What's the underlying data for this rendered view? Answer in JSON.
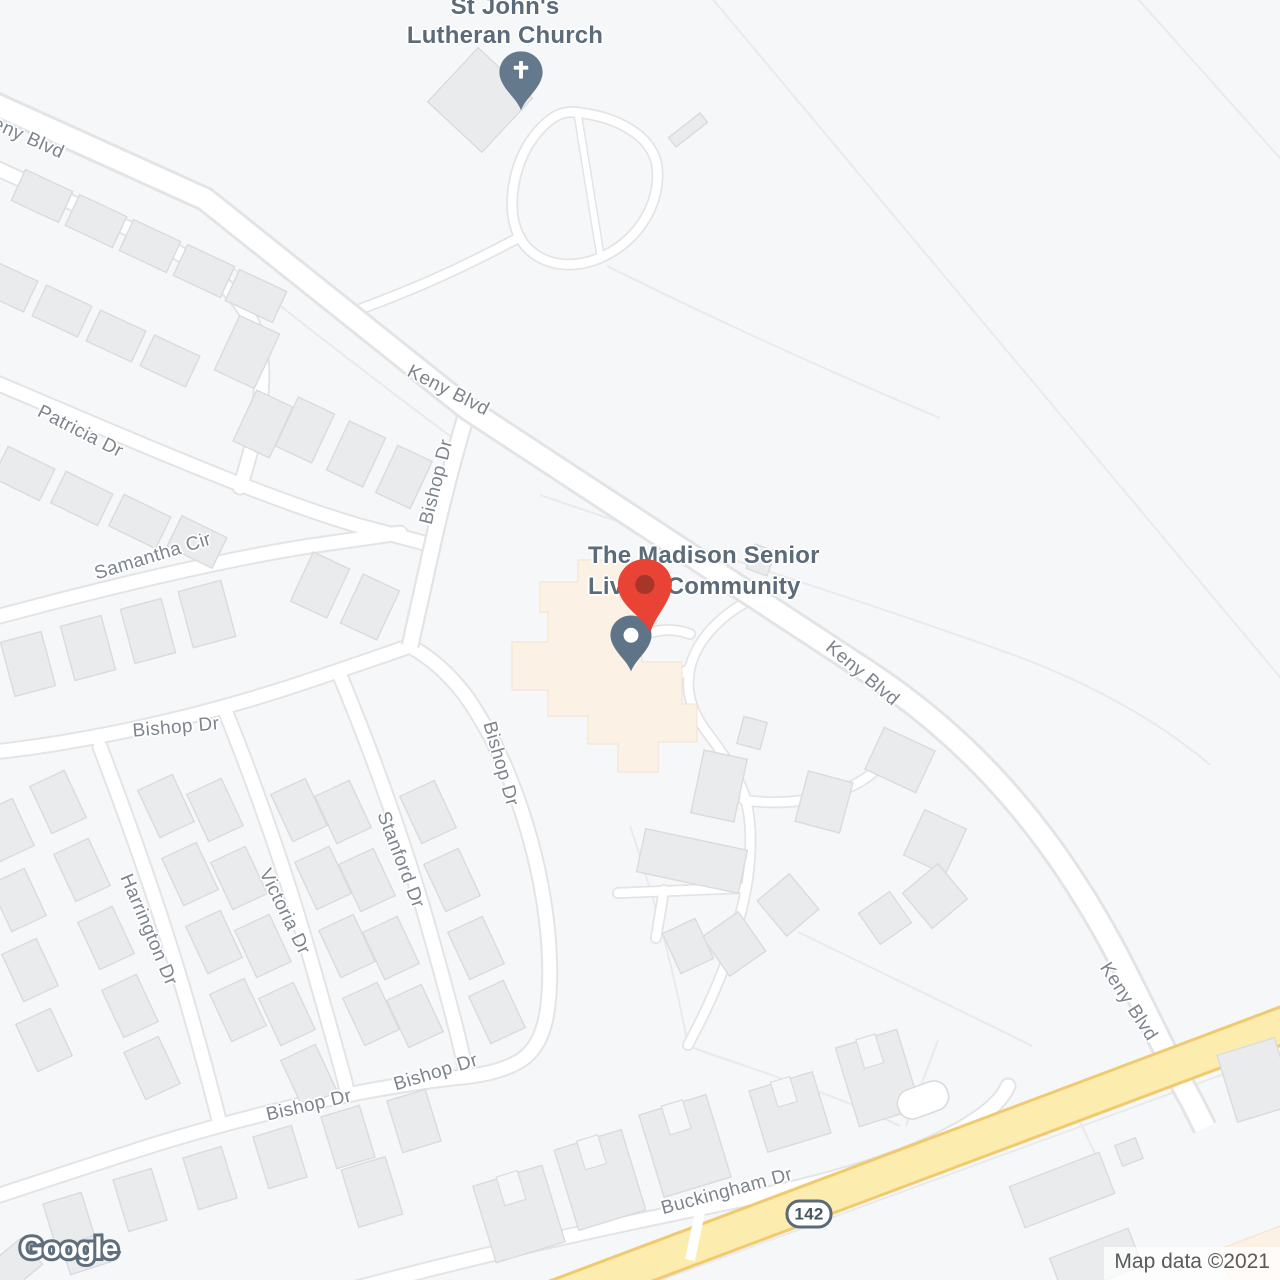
{
  "map": {
    "watermark": "Google",
    "attribution": "Map data ©2021"
  },
  "route_shield": {
    "number": "142"
  },
  "poi_labels": {
    "church": {
      "line1": "St John's",
      "line2": "Lutheran Church"
    },
    "madison": {
      "line1": "The Madison Senior",
      "line2": "Living Community"
    }
  },
  "markers": {
    "church_pin": "church-pin",
    "madison_place_pin": "red-place-pin",
    "madison_poi_pin": "slate-poi-pin"
  },
  "road_labels": [
    {
      "id": "keny-blvd-1",
      "text": "Keny Blvd",
      "x": 22,
      "y": 136,
      "rot": 24
    },
    {
      "id": "keny-blvd-2",
      "text": "Keny Blvd",
      "x": 448,
      "y": 391,
      "rot": 27
    },
    {
      "id": "keny-blvd-3",
      "text": "Keny Blvd",
      "x": 862,
      "y": 674,
      "rot": 40
    },
    {
      "id": "keny-blvd-4",
      "text": "Keny Blvd",
      "x": 1128,
      "y": 1002,
      "rot": 57
    },
    {
      "id": "bishop-dr-1",
      "text": "Bishop Dr",
      "x": 437,
      "y": 482,
      "rot": -76
    },
    {
      "id": "patricia-dr",
      "text": "Patricia Dr",
      "x": 80,
      "y": 432,
      "rot": 27
    },
    {
      "id": "samantha-cir",
      "text": "Samantha Cir",
      "x": 153,
      "y": 557,
      "rot": -17
    },
    {
      "id": "bishop-dr-2",
      "text": "Bishop Dr",
      "x": 176,
      "y": 728,
      "rot": -5
    },
    {
      "id": "bishop-dr-3",
      "text": "Bishop Dr",
      "x": 500,
      "y": 764,
      "rot": 74
    },
    {
      "id": "stanford-dr",
      "text": "Stanford Dr",
      "x": 400,
      "y": 860,
      "rot": 69
    },
    {
      "id": "victoria-dr",
      "text": "Victoria Dr",
      "x": 284,
      "y": 912,
      "rot": 64
    },
    {
      "id": "harrington-dr",
      "text": "Harrington Dr",
      "x": 148,
      "y": 930,
      "rot": 67
    },
    {
      "id": "bishop-dr-4",
      "text": "Bishop Dr",
      "x": 309,
      "y": 1106,
      "rot": -13
    },
    {
      "id": "bishop-dr-5",
      "text": "Bishop Dr",
      "x": 436,
      "y": 1073,
      "rot": -17
    },
    {
      "id": "buckingham-dr",
      "text": "Buckingham Dr",
      "x": 727,
      "y": 1192,
      "rot": -15
    }
  ],
  "colors": {
    "map_background": "#f6f7f8",
    "road_fill": "#ffffff",
    "road_casing": "#e3e4e6",
    "highway_fill": "#fcecae",
    "highway_casing": "#f1ca70",
    "building_fill": "#eaebed",
    "building_stroke": "#d9dbdd",
    "poi_building_fill": "#fbf1e4",
    "poi_label": "#5c6b79",
    "road_label": "#7d848e",
    "pin_red": "#e94335",
    "pin_red_core": "#a8352a",
    "pin_slate": "#64798c",
    "attribution_text": "#5a5a5a"
  }
}
